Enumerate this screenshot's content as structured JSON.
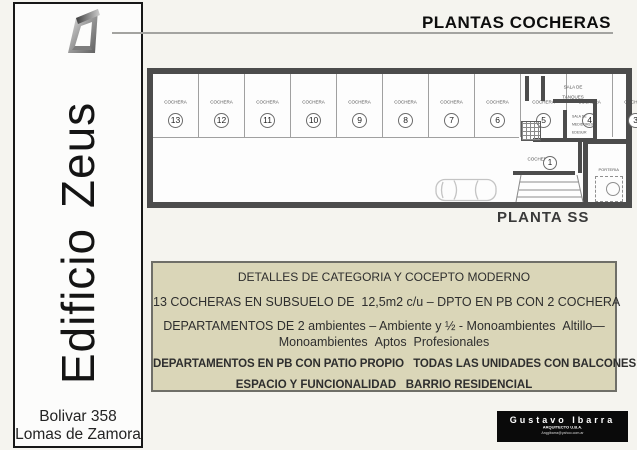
{
  "header": {
    "title": "PLANTAS COCHERAS"
  },
  "sidebar": {
    "building_name": "Edificio  Zeus",
    "address_line1": "Bolivar 358",
    "address_line2": "Lomas de Zamora"
  },
  "plan": {
    "name": "PLANTA SS",
    "stalls": [
      {
        "label": "COCHERA",
        "number": "13"
      },
      {
        "label": "COCHERA",
        "number": "12"
      },
      {
        "label": "COCHERA",
        "number": "11"
      },
      {
        "label": "COCHERA",
        "number": "10"
      },
      {
        "label": "COCHERA",
        "number": "9"
      },
      {
        "label": "COCHERA",
        "number": "8"
      },
      {
        "label": "COCHERA",
        "number": "7"
      },
      {
        "label": "COCHERA",
        "number": "6"
      },
      {
        "label": "COCHERA",
        "number": "5"
      },
      {
        "label": "COCHERA",
        "number": "4"
      },
      {
        "label": "COCHERA",
        "number": "3"
      },
      {
        "label": "COCHERA",
        "number": "2"
      }
    ],
    "stall_1": {
      "label": "COCHERA",
      "number": "1"
    },
    "rooms": {
      "tanks_line1": "SALA DE",
      "tanks_line2": "TANQUES",
      "meters_line1": "SALA DE",
      "meters_line2": "MEDIDORES",
      "meters_line3": "EDESUR",
      "small_room": "PORTERIA"
    }
  },
  "details_box": {
    "line1": "DETALLES DE CATEGORIA Y COCEPTO MODERNO",
    "line2": "13 COCHERAS EN SUBSUELO DE  12,5m2 c/u – DPTO EN PB CON 2 COCHERA",
    "line3": "DEPARTAMENTOS DE 2 ambientes – Ambiente y ½ - Monoambientes  Altillo—",
    "line4": "Monoambientes  Aptos  Profesionales",
    "line5": "DEPARTAMENTOS EN PB CON PATIO PROPIO   TODAS LAS UNIDADES CON BALCONES",
    "line6": "ESPACIO Y FUNCIONALIDAD   BARRIO RESIDENCIAL"
  },
  "architect_card": {
    "name": "Gustavo Ibarra",
    "title": "ARQUITECTO U.B.A.",
    "email": "Arqgibarra@yahoo.com.ar"
  },
  "colors": {
    "page_bg": "#f5f4ef",
    "wall": "#4c4c4c",
    "details_box_bg": "#dad6b8",
    "card_bg": "#0a0a0a"
  }
}
